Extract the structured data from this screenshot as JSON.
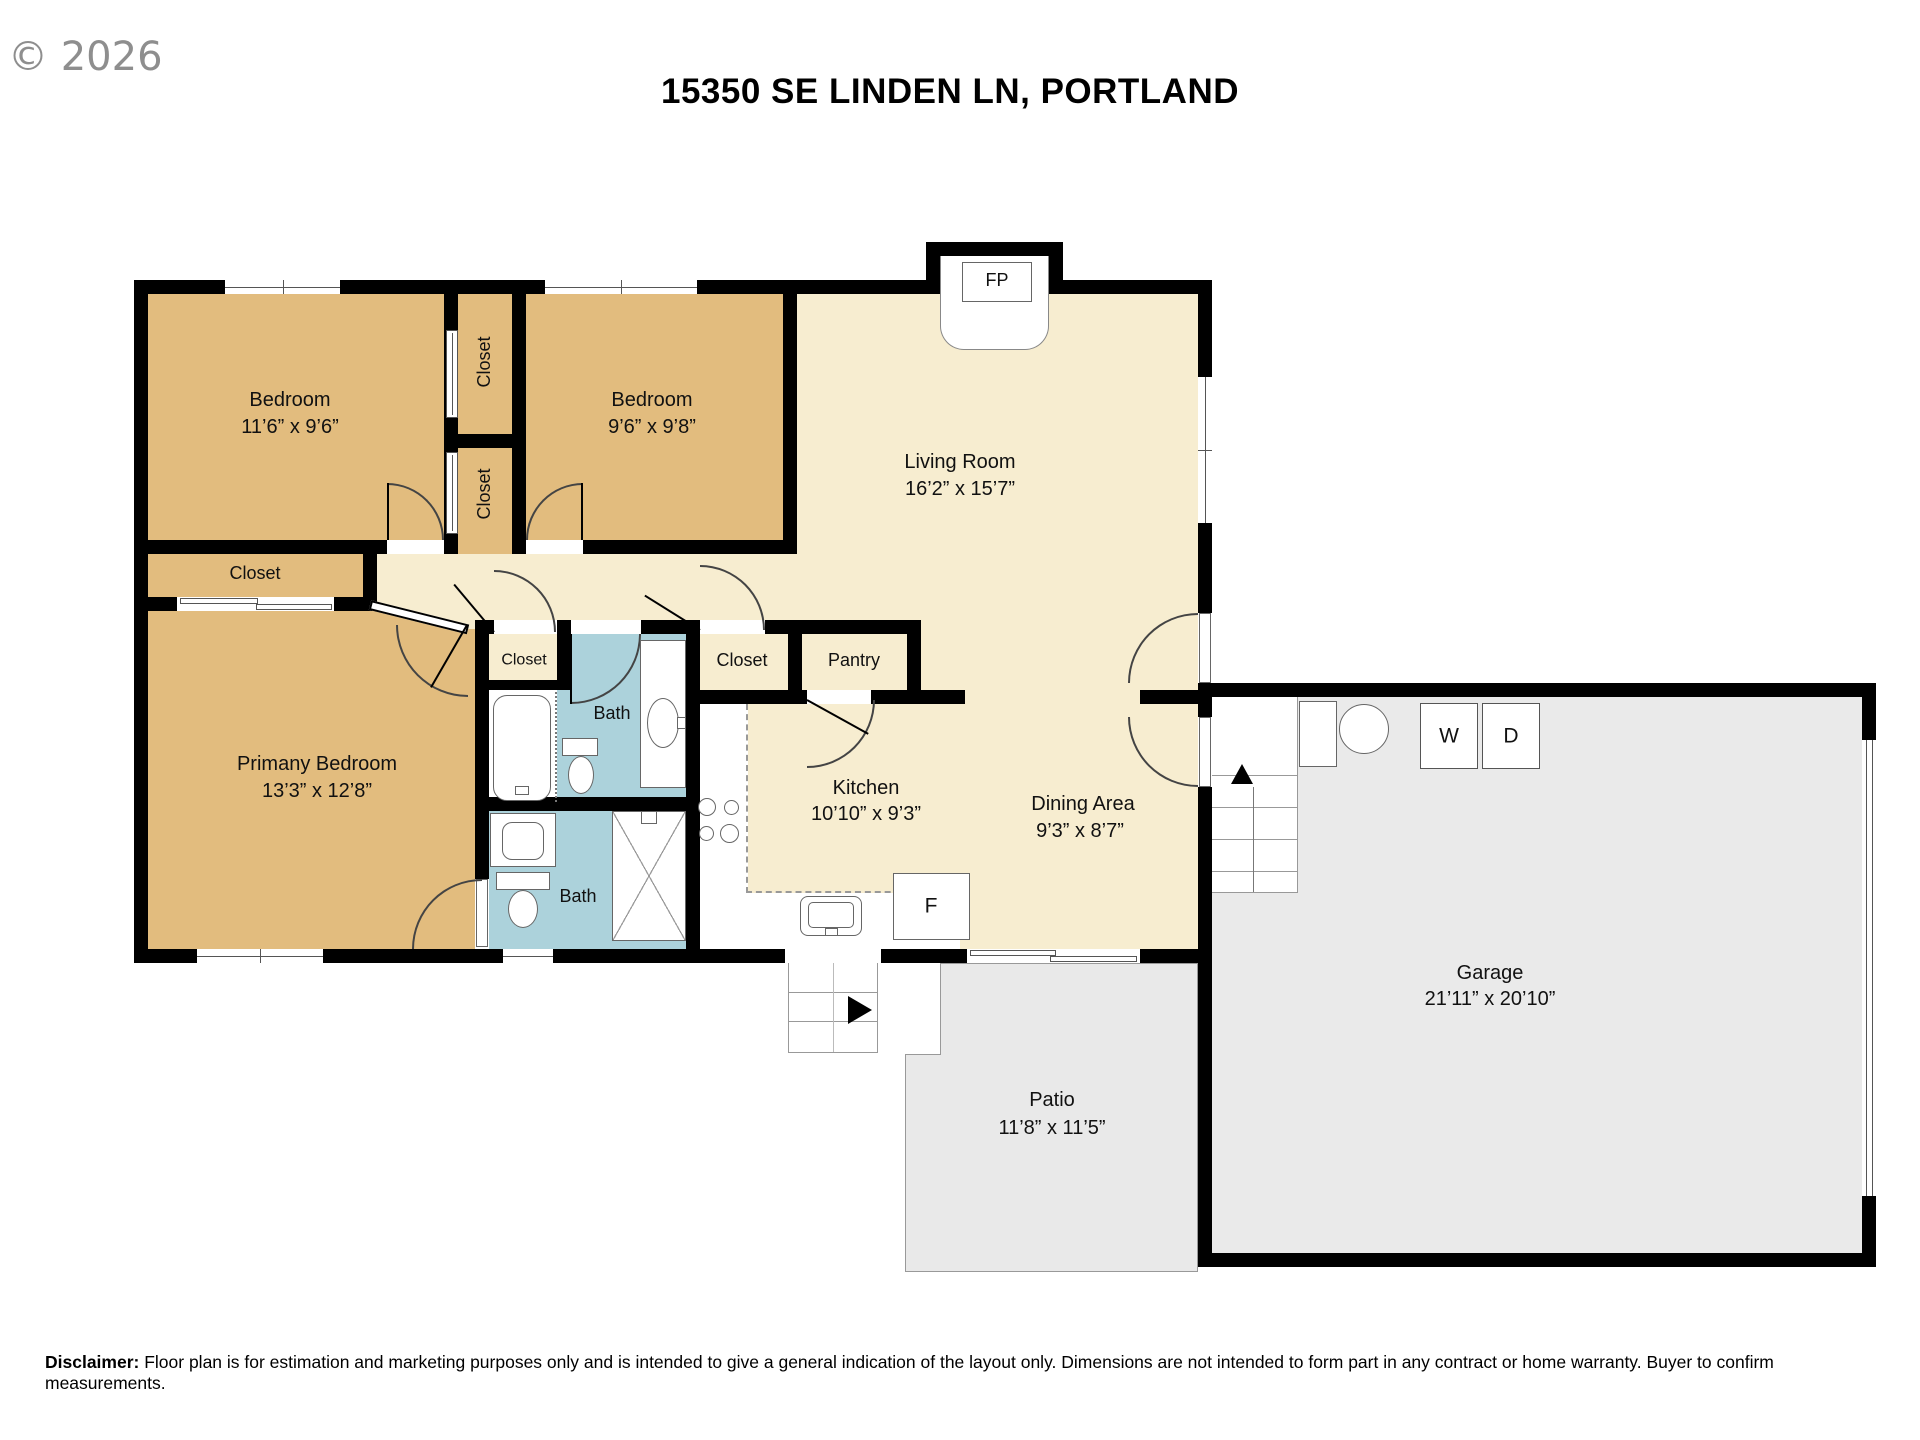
{
  "watermark": "© 2026",
  "title": "15350 SE LINDEN LN, PORTLAND",
  "disclaimer": {
    "label": "Disclaimer:",
    "text": " Floor plan is for estimation and marketing purposes only and is intended to give a general indication of the layout only. Dimensions are not intended to form part in any contract or home warranty. Buyer to confirm measurements."
  },
  "rooms": {
    "bedroom1": {
      "name": "Bedroom",
      "dims": "11’6” x 9’6”"
    },
    "bedroom2": {
      "name": "Bedroom",
      "dims": "9’6” x 9’8”"
    },
    "living": {
      "name": "Living Room",
      "dims": "16’2” x 15’7”"
    },
    "primary": {
      "name": "Primany Bedroom",
      "dims": "13’3” x 12’8”"
    },
    "kitchen": {
      "name": "Kitchen",
      "dims": "10’10” x 9’3”"
    },
    "dining": {
      "name": "Dining Area",
      "dims": "9’3” x 8’7”"
    },
    "garage": {
      "name": "Garage",
      "dims": "21’11” x 20’10”"
    },
    "patio": {
      "name": "Patio",
      "dims": "11’8” x 11’5”"
    }
  },
  "labels": {
    "closet": "Closet",
    "pantry": "Pantry",
    "bath": "Bath",
    "fireplace": "FP",
    "washer": "W",
    "dryer": "D",
    "fridge": "F"
  },
  "colors": {
    "wall": "#000000",
    "bedroom": "#E2BC7E",
    "floor": "#F7EDD0",
    "bath": "#ACD2DB",
    "garage": "#EAEAEA",
    "patio": "#E9E9E9",
    "fixture_line": "#666666",
    "text": "#111111",
    "watermark": "#8E8E8E"
  }
}
